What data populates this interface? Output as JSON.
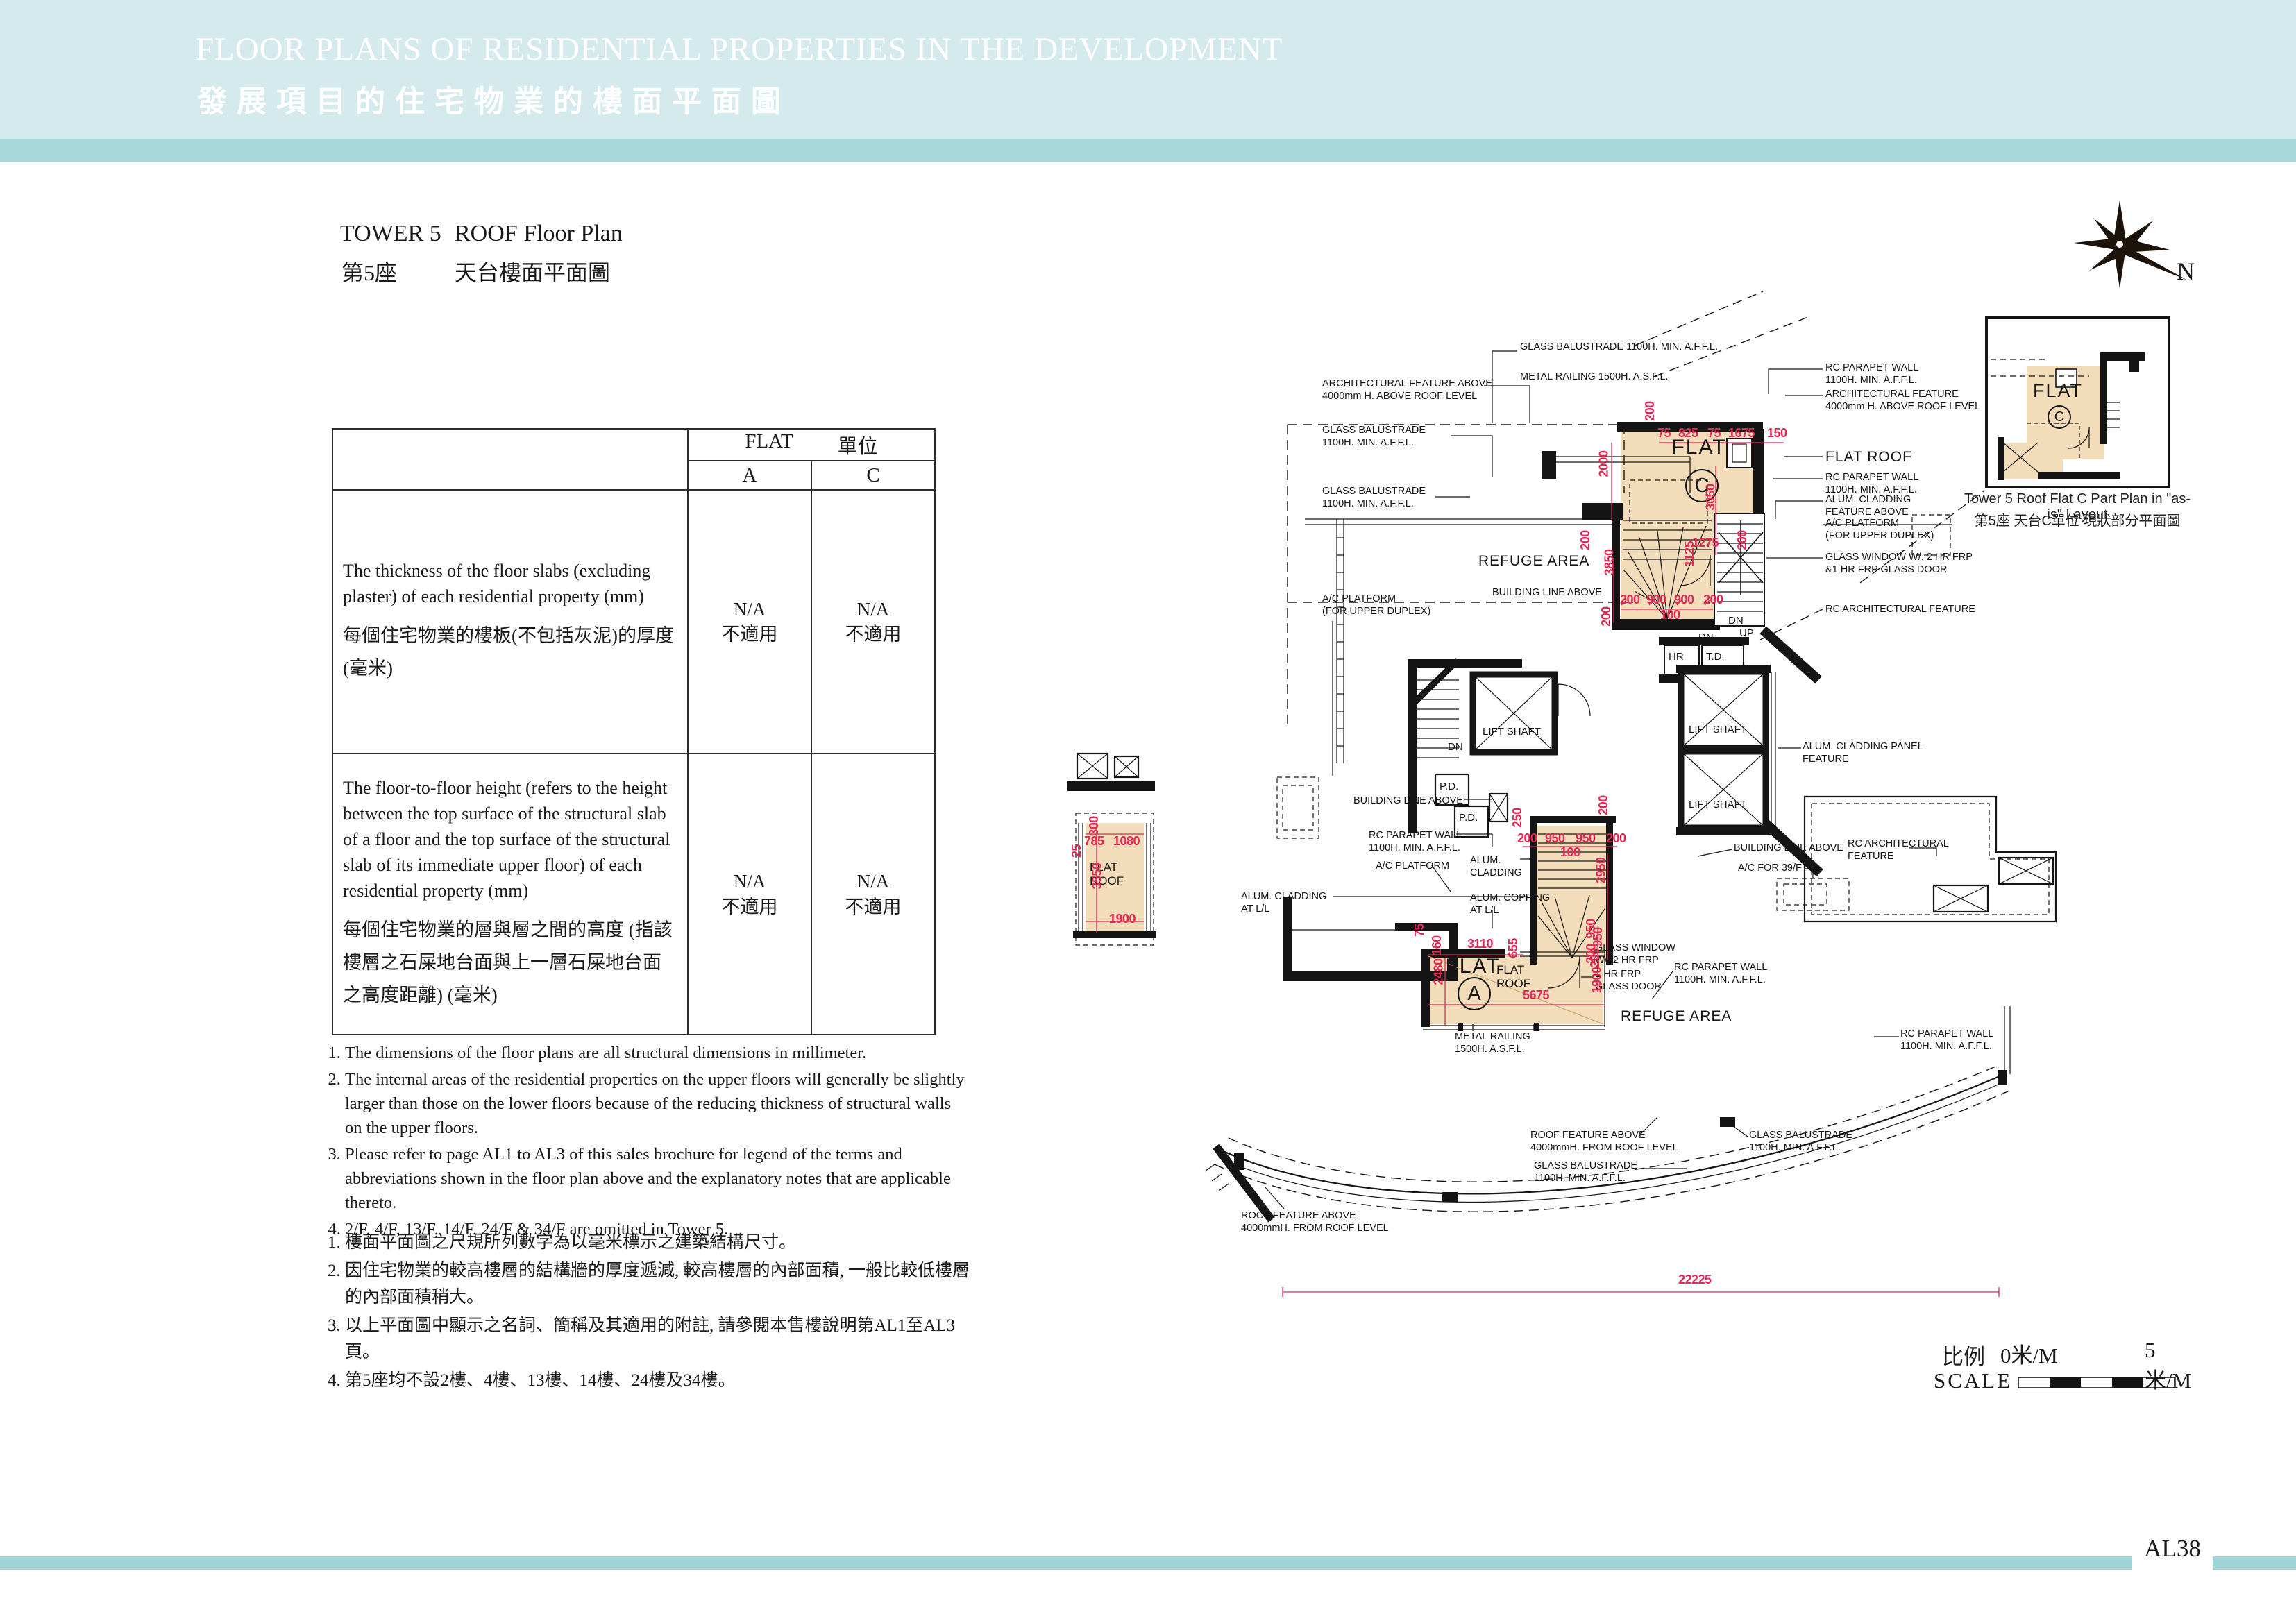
{
  "header": {
    "title_en": "FLOOR PLANS OF RESIDENTIAL PROPERTIES IN THE DEVELOPMENT",
    "title_zh": "發展項目的住宅物業的樓面平面圖"
  },
  "plan_title": {
    "tower_en": "TOWER 5",
    "name_en": "ROOF Floor Plan",
    "tower_zh": "第5座",
    "name_zh": "天台樓面平面圖"
  },
  "table": {
    "flat_header_en": "FLAT",
    "flat_header_zh": "單位",
    "columns": [
      "A",
      "C"
    ],
    "rows": [
      {
        "label_en": "The thickness of the floor slabs (excluding plaster) of each residential property (mm)",
        "label_zh": "每個住宅物業的樓板(不包括灰泥)的厚度(毫米)",
        "values": [
          {
            "en": "N/A",
            "zh": "不適用"
          },
          {
            "en": "N/A",
            "zh": "不適用"
          }
        ]
      },
      {
        "label_en": "The floor-to-floor height (refers to the height between the top surface of the structural slab of a floor and the top surface of the structural slab of its immediate upper floor) of each residential property (mm)",
        "label_zh": "每個住宅物業的層與層之間的高度 (指該樓層之石屎地台面與上一層石屎地台面之高度距離) (毫米)",
        "values": [
          {
            "en": "N/A",
            "zh": "不適用"
          },
          {
            "en": "N/A",
            "zh": "不適用"
          }
        ]
      }
    ]
  },
  "notes_en": [
    "The dimensions of the floor plans are all structural dimensions in millimeter.",
    "The internal areas of the residential properties on the upper floors will generally be slightly larger than those on the lower floors because of the reducing thickness of structural walls on the upper floors.",
    "Please refer to page AL1 to AL3 of this sales brochure for legend of the terms and abbreviations shown in the floor plan above and the explanatory notes that are applicable thereto.",
    "2/F, 4/F, 13/F, 14/F, 24/F & 34/F are omitted in Tower 5."
  ],
  "notes_zh": [
    "樓面平面圖之尺規所列數字為以毫米標示之建築結構尺寸。",
    "因住宅物業的較高樓層的結構牆的厚度遞減, 較高樓層的內部面積, 一般比較低樓層的內部面積稍大。",
    "以上平面圖中顯示之名詞、簡稱及其適用的附註, 請參閱本售樓說明第AL1至AL3頁。",
    "第5座均不設2樓、4樓、13樓、14樓、24樓及34樓。"
  ],
  "plan": {
    "compass": "N",
    "ann": [
      "GLASS BALUSTRADE 1100H. MIN. A.F.F.L.",
      "METAL RAILING 1500H. A.S.F.L.",
      "ARCHITECTURAL FEATURE ABOVE\n4000mm H. ABOVE ROOF LEVEL",
      "GLASS BALUSTRADE\n1100H. MIN. A.F.F.L.",
      "GLASS BALUSTRADE\n1100H. MIN. A.F.F.L.",
      "A/C PLATFORM\n(FOR UPPER DUPLEX)",
      "RC PARAPET WALL\n1100H. MIN. A.F.F.L.",
      "ARCHITECTURAL FEATURE\n4000mm H. ABOVE ROOF LEVEL",
      "FLAT ROOF",
      "RC PARAPET WALL\n1100H. MIN. A.F.F.L.",
      "ALUM. CLADDING\nFEATURE ABOVE",
      "A/C PLATFORM\n(FOR UPPER DUPLEX)",
      "GLASS WINDOW W/. 2 HR FRP\n&1 HR FRP GLASS DOOR",
      "RC ARCHITECTURAL FEATURE",
      "REFUGE AREA",
      "BUILDING LINE ABOVE",
      "ALUM. CLADDING PANEL\nFEATURE",
      "BUILDING LINE ABOVE",
      "RC PARAPET WALL\n1100H. MIN. A.F.F.L.",
      "A/C PLATFORM",
      "ALUM.\nCLADDING",
      "ALUM. COPPING\nAT L/L",
      "ALUM. CLADDING\nAT L/L",
      "BUILDING LINE ABOVE",
      "A/C FOR 39/F",
      "RC ARCHITECTURAL\nFEATURE",
      "GLASS WINDOW\nW/. 2 HR FRP",
      "1 HR FRP\nGLASS DOOR",
      "RC PARAPET WALL\n1100H. MIN. A.F.F.L.",
      "REFUGE AREA",
      "METAL RAILING\n1500H. A.S.F.L.",
      "RC PARAPET WALL\n1100H. MIN. A.F.F.L.",
      "ROOF FEATURE ABOVE\n4000mmH. FROM ROOF LEVEL",
      "GLASS BALUSTRADE\n1100H. MIN. A.F.F.L.",
      "GLASS BALUSTRADE\n1100H. MIN. A.F.F.L.",
      "ROOF FEATURE ABOVE\n4000mmH. FROM ROOF LEVEL"
    ],
    "rooms": [
      "FLAT",
      "C",
      "FLAT",
      "A",
      "FLAT\nROOF",
      "FLAT\nROOF",
      "LIFT SHAFT",
      "LIFT SHAFT",
      "LIFT SHAFT",
      "P.D.",
      "P.D.",
      "HR",
      "T.D.",
      "DN",
      "DN",
      "DN",
      "UP"
    ],
    "dims": [
      "200",
      "75",
      "825",
      "75",
      "1675",
      "150",
      "2000",
      "3050",
      "200",
      "1125",
      "1275",
      "200",
      "3850",
      "200",
      "900",
      "900",
      "200",
      "100",
      "200",
      "250",
      "200",
      "200",
      "950",
      "950",
      "200",
      "100",
      "2950",
      "950",
      "200",
      "75",
      "160",
      "3110",
      "655",
      "2480",
      "5675",
      "200",
      "1900",
      "950",
      "300",
      "785",
      "1080",
      "25",
      "3550",
      "1900",
      "22225"
    ],
    "inset": {
      "flat": "FLAT",
      "letter": "C",
      "caption_en": "Tower 5 Roof Flat C Part Plan in \"as-is\" Layout",
      "caption_zh": "第5座 天台C單位 現狀部分平面圖"
    },
    "scale": {
      "label_zh": "比例",
      "label_en": "SCALE",
      "zero": "0米/M",
      "five": "5米/M"
    }
  },
  "footer": {
    "page": "AL38"
  }
}
